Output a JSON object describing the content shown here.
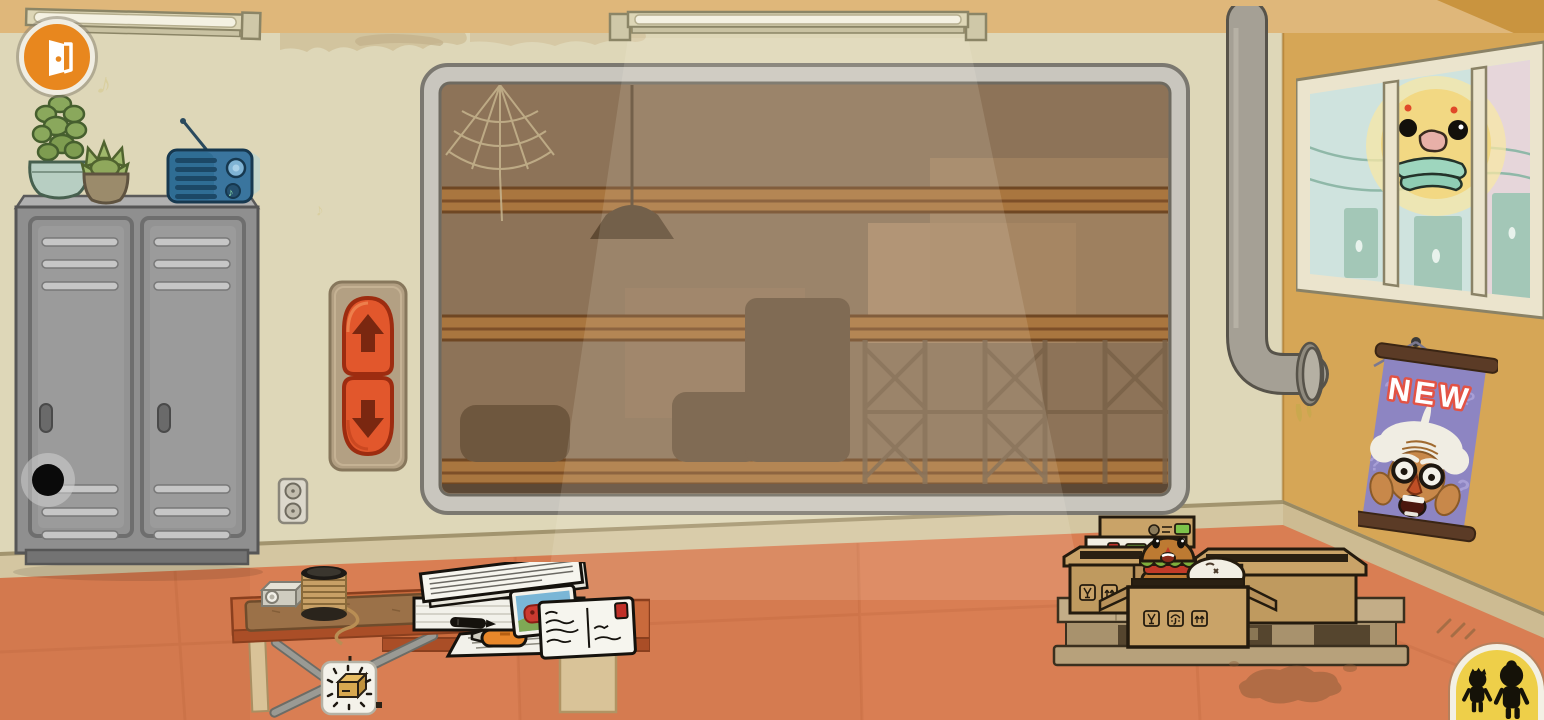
{
  "scene": {
    "name": "Cartoon storage room with storeroom window, lockers, shipping boxes on a pallet"
  },
  "hud": {
    "exit_button": {
      "icon": "door-exit-icon",
      "color": "#e8871e"
    },
    "character_tray_button": {
      "icon": "characters-icon",
      "color": "#eecf49"
    }
  },
  "shelf_controls": {
    "panel_color": "#b3a083",
    "up": {
      "icon": "arrow-up-icon",
      "color": "#e2572c"
    },
    "down": {
      "icon": "arrow-down-icon",
      "color": "#e2572c"
    }
  },
  "poster": {
    "text": "NEW",
    "background": "#8d85c2",
    "outline": "#e25345"
  },
  "decor": {
    "music_note": "♪",
    "question_mark": "?"
  },
  "shipping": {
    "box_icons": [
      "fragile-glass-icon",
      "umbrella-icon",
      "this-side-up-icon"
    ],
    "label_colors": {
      "green": "#7cc24a",
      "red": "#c03028"
    }
  },
  "palette": {
    "wall": "#ded7b8",
    "wall_top_band": "#dfb77a",
    "side_wall": "#d6a656",
    "floor": "#d97e53",
    "baseboard": "#d4c6a1",
    "window_frame": "#c9c6be",
    "storeroom_interior": "#8d7358",
    "shelf_wood": "#a9763f",
    "locker": "#929292",
    "cardboard": "#c9a368",
    "radio": "#2f6d94",
    "table": "#c96a3c",
    "pipe": "#a5a095"
  }
}
